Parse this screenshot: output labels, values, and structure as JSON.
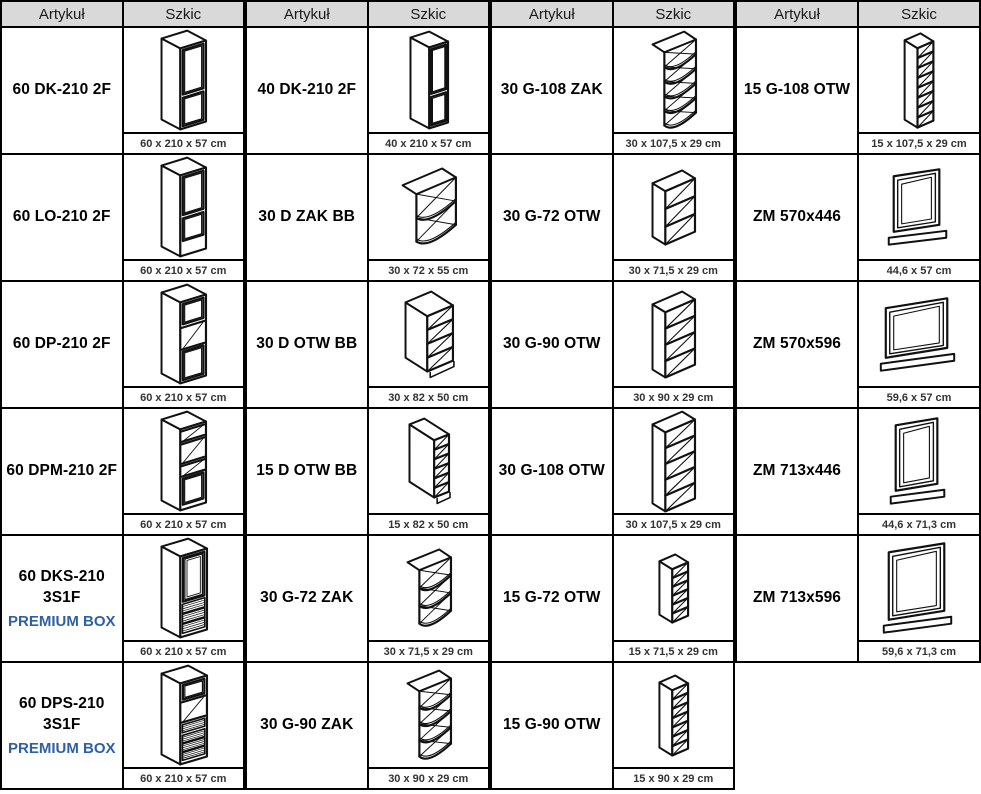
{
  "table": {
    "header": {
      "artykul_label": "Artykuł",
      "szkic_label": "Szkic"
    },
    "style": {
      "header_bg": "#d9d9d9",
      "line_color": "#111111",
      "premium_text_color": "#2e5fa8",
      "dims_text_color": "#333333"
    },
    "groups": [
      {
        "rows": [
          {
            "article": "60 DK-210 2F",
            "dims": "60 x 210 x 57 cm",
            "sketch": "tall-dk60"
          },
          {
            "article": "60 LO-210 2F",
            "dims": "60 x 210 x 57 cm",
            "sketch": "tall-lo60"
          },
          {
            "article": "60 DP-210 2F",
            "dims": "60 x 210 x 57 cm",
            "sketch": "tall-dp60"
          },
          {
            "article": "60 DPM-210 2F",
            "dims": "60 x 210 x 57 cm",
            "sketch": "tall-dpm60"
          },
          {
            "article": "60 DKS-210 3S1F",
            "note": "PREMIUM BOX",
            "dims": "60 x 210 x 57 cm",
            "sketch": "tall-dks60"
          },
          {
            "article": "60 DPS-210 3S1F",
            "note": "PREMIUM BOX",
            "dims": "60 x 210 x 57 cm",
            "sketch": "tall-dps60"
          }
        ]
      },
      {
        "rows": [
          {
            "article": "40 DK-210 2F",
            "dims": "40 x 210 x 57 cm",
            "sketch": "tall-dk40"
          },
          {
            "article": "30 D ZAK BB",
            "dims": "30 x 72 x 55 cm",
            "sketch": "corner-zak30d"
          },
          {
            "article": "30 D OTW BB",
            "dims": "30 x 82 x 50 cm",
            "sketch": "base-otw30"
          },
          {
            "article": "15 D OTW BB",
            "dims": "15 x 82 x 50 cm",
            "sketch": "base-otw15"
          },
          {
            "article": "30 G-72 ZAK",
            "dims": "30 x 71,5 x 29 cm",
            "sketch": "corner-g72"
          },
          {
            "article": "30 G-90 ZAK",
            "dims": "30 x 90 x 29 cm",
            "sketch": "corner-g90"
          }
        ]
      },
      {
        "rows": [
          {
            "article": "30 G-108 ZAK",
            "dims": "30 x 107,5 x 29 cm",
            "sketch": "corner-g108"
          },
          {
            "article": "30 G-72 OTW",
            "dims": "30 x 71,5 x 29 cm",
            "sketch": "wall-g72"
          },
          {
            "article": "30 G-90 OTW",
            "dims": "30 x 90 x 29 cm",
            "sketch": "wall-g90"
          },
          {
            "article": "30 G-108 OTW",
            "dims": "30 x 107,5 x 29 cm",
            "sketch": "wall-g108"
          },
          {
            "article": "15 G-72 OTW",
            "dims": "15 x 71,5 x 29 cm",
            "sketch": "wall-g72-15"
          },
          {
            "article": "15 G-90 OTW",
            "dims": "15 x 90 x 29 cm",
            "sketch": "wall-g90-15"
          }
        ]
      },
      {
        "rows": [
          {
            "article": "15 G-108 OTW",
            "dims": "15 x 107,5 x 29 cm",
            "sketch": "wall-g108-15"
          },
          {
            "article": "ZM 570x446",
            "dims": "44,6 x 57 cm",
            "sketch": "frame-446x570"
          },
          {
            "article": "ZM 570x596",
            "dims": "59,6 x 57 cm",
            "sketch": "frame-596x570"
          },
          {
            "article": "ZM 713x446",
            "dims": "44,6 x 71,3 cm",
            "sketch": "frame-446x713"
          },
          {
            "article": "ZM 713x596",
            "dims": "59,6 x 71,3 cm",
            "sketch": "frame-596x713"
          }
        ]
      }
    ]
  }
}
